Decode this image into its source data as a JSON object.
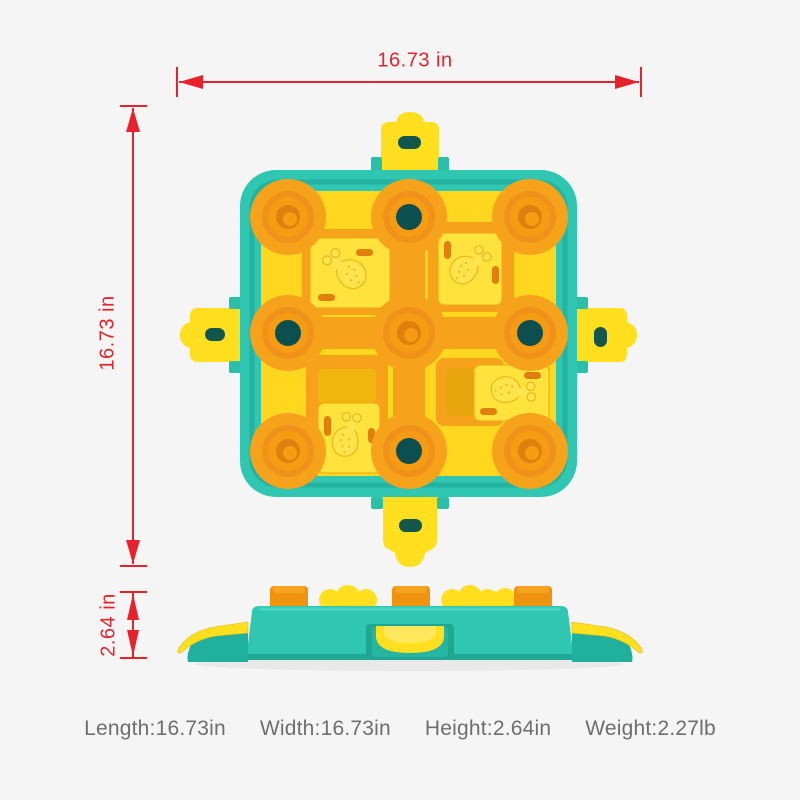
{
  "dimensions": {
    "width_label": "16.73 in",
    "height_label": "16.73 in",
    "side_height_label": "2.64 in"
  },
  "caption": {
    "items": [
      "Length:16.73in",
      "Width:16.73in",
      "Height:2.64in",
      "Weight:2.27lb"
    ]
  },
  "colors": {
    "background": "#f5f5f6",
    "dimension_red": "#e8222a",
    "teal": "#2fc7b2",
    "teal_dark": "#0c4f50",
    "board_yellow": "#ffd71f",
    "tile_yellow": "#ffe23c",
    "tab_yellow": "#ffdf1e",
    "track_orange": "#f7a21b",
    "ring_orange": "#f0921a",
    "deep_orange": "#e07f0d",
    "slot_dark": "#13564e",
    "caption_gray": "#6e6e6e"
  }
}
